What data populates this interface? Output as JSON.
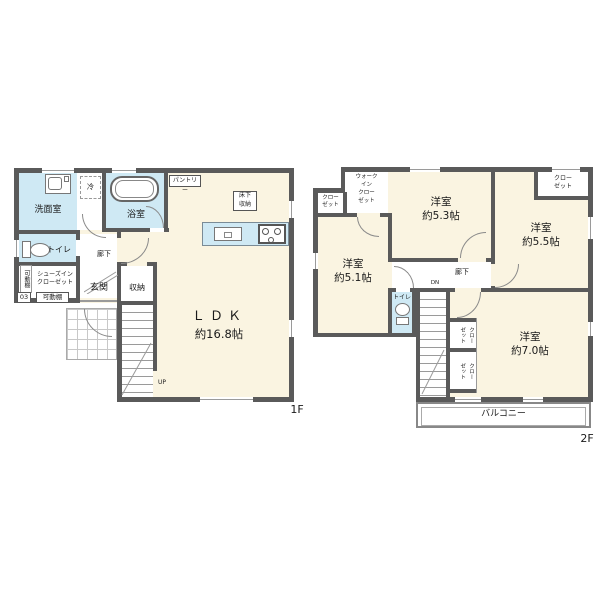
{
  "title": "戸建て間取り図 3LDK",
  "colors": {
    "wall": "#5a5a5a",
    "room_fill": "#faf4e1",
    "wet_fill": "#cfe9f4",
    "label": "#1a1a1a"
  },
  "floor1": {
    "floor_label": "1F",
    "rooms": {
      "washroom": "洗面室",
      "refrigerator": "冷",
      "bathroom": "浴室",
      "pantry": "パントリー",
      "underfloor_storage": "床下\n収納",
      "toilet": "トイレ",
      "hallway": "廊下",
      "movable_shelf_vertical": "可動棚",
      "movable_shelf_horizontal": "可動棚",
      "shoes_in_closet": "シューズイン\nクローゼット",
      "unit_number": "03",
      "entrance": "玄関",
      "storage": "収納",
      "ldk_name": "ＬＤＫ",
      "ldk_size": "約16.8帖",
      "stairs_up": "UP"
    }
  },
  "floor2": {
    "floor_label": "2F",
    "rooms": {
      "closet_top_left": "クロー\nゼット",
      "walk_in_closet": "ウォーク\nイン\nクロー\nゼット",
      "bedroom_53": "洋室\n約5.3帖",
      "closet_top_right": "クロー\nゼット",
      "bedroom_55": "洋室\n約5.5帖",
      "bedroom_51": "洋室\n約5.1帖",
      "hallway": "廊下",
      "stairs_down": "DN",
      "toilet": "トイレ",
      "closet_middle": "クロー\nゼット",
      "closet_lower": "クロー\nゼット",
      "bedroom_70": "洋室\n約7.0帖",
      "balcony": "バルコニー"
    }
  }
}
